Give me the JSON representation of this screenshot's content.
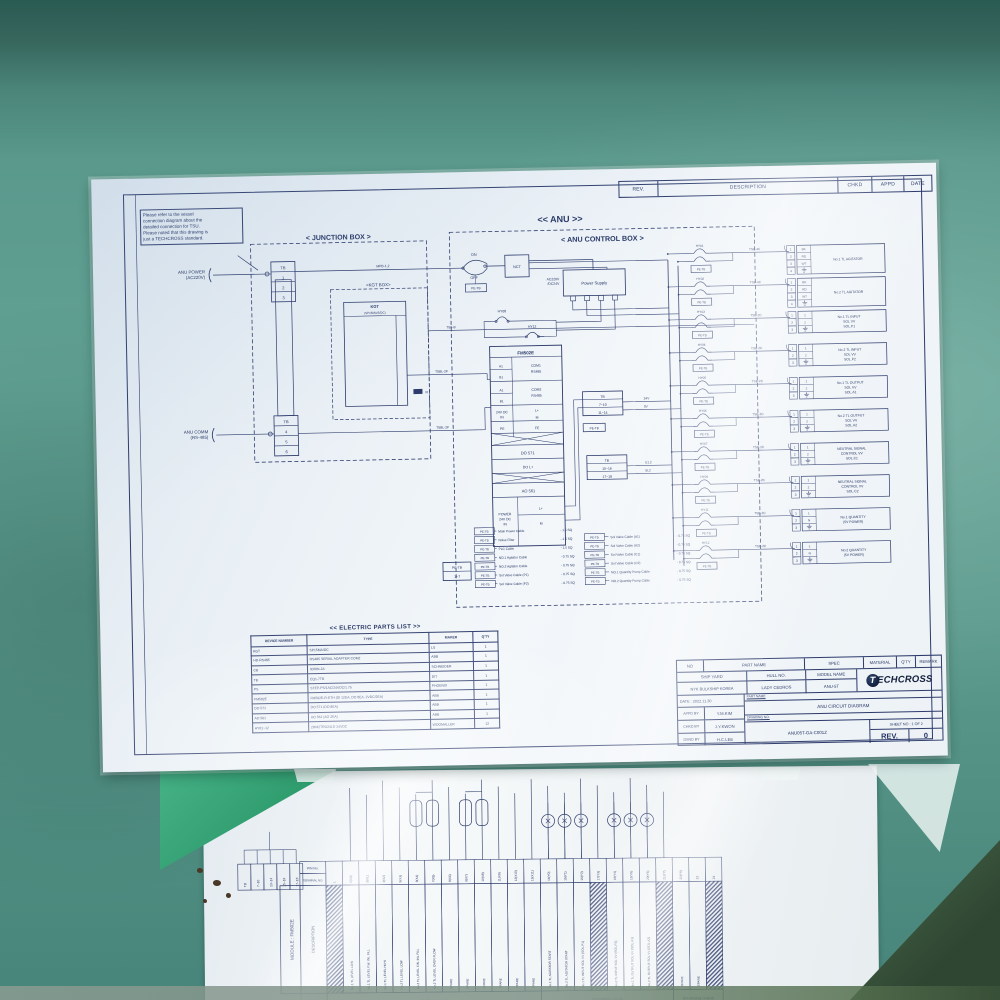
{
  "colors": {
    "surface_teal": "#5a998c",
    "mat_green": "#2f9c6e",
    "paper": "#f3f7fa",
    "ink": "#2c3a6b",
    "logo_navy": "#131f3d"
  },
  "sheet1": {
    "rev_headers": [
      "REV.",
      "DESCRIPTION",
      "CHKD",
      "APPD",
      "DATE"
    ],
    "note_lines": [
      "Please refer to the vessel",
      "connection diagram about the",
      "detailed connection for TSU.",
      "Please noted that this drawing is",
      "just a TECHCROSS standard."
    ],
    "anu": "<< ANU >>",
    "jb": "< JUNCTION BOX >",
    "cb": "< ANU CONTROL BOX >",
    "kgt_box": "<KGT BOX>",
    "anu_power": [
      "ANU POWER",
      "(AC220V)"
    ],
    "anu_comm": [
      "ANU COMM",
      "(RS-485)"
    ],
    "tb": "TB",
    "tb_top": [
      "1",
      "2",
      "3"
    ],
    "tb_bot": [
      "4",
      "5",
      "6"
    ],
    "mpb": "MPB-1,2",
    "kgt": {
      "name": "KGT",
      "type": "(SP15MA/5/DC)",
      "rows": [
        [
          "LEFT TL",
          "ALRM",
          "LAMP"
        ],
        [
          "RIGHT TL",
          "ALRM",
          "LAMP"
        ],
        [
          "POWER",
          ""
        ]
      ],
      "pin_labels": [
        "RTB-P",
        "RTB-N",
        "RT15-P",
        "RT15-N",
        "VTB",
        "GND"
      ],
      "com": [
        "COM",
        "(RS485)"
      ],
      "com_pins": [
        "485(A)",
        "485(B)",
        "485(A)",
        "485(B)"
      ],
      "com_wires": [
        "485(+)",
        "485(-)"
      ],
      "r": "R"
    },
    "long_wires": [
      "TSB-B",
      "TSBL-2P",
      "TSBL-2P"
    ],
    "on": "ON",
    "off": "OFF",
    "nct": "NCT",
    "petb": "PE-TB",
    "ps": [
      "Power Supply",
      "AC220V",
      "/DC24V"
    ],
    "hy_top": [
      "HY08",
      "HY12"
    ],
    "module": {
      "name": "FM502E",
      "com1": [
        "COM1",
        "RS485"
      ],
      "com2": [
        "COM2",
        "RS485"
      ],
      "a1": "A1",
      "b1": "B1",
      "dc": [
        "24V DC",
        "IN"
      ],
      "lp": "L+",
      "m": "M",
      "pe": "PE",
      "fe": "FE",
      "do571": "DO 571",
      "dol": "DO L+",
      "ao561": "AO 561",
      "power": [
        "POWER",
        "24V DC",
        "IN"
      ]
    },
    "tb1": [
      "TB",
      "7~10",
      "11~14"
    ],
    "tb2": [
      "TB",
      "15~16",
      "17~18"
    ],
    "wire_24": [
      "24V",
      "0V"
    ],
    "wire_u": [
      "U1.2",
      "SL2"
    ]
  },
  "outputs": [
    {
      "relay": "HY01",
      "cable": "TSB-4C",
      "pins": [
        "1",
        "2",
        "3",
        "4"
      ],
      "names": [
        "BK",
        "RD",
        "WT",
        "G"
      ],
      "label": [
        "No.1 TL AGITATOR"
      ]
    },
    {
      "relay": "HY02",
      "cable": "TSB-4C",
      "pins": [
        "1",
        "2",
        "3",
        "4"
      ],
      "names": [
        "BK",
        "RD",
        "WT",
        "G"
      ],
      "label": [
        "No.2 TL AGITATOR"
      ]
    },
    {
      "relay": "HY03",
      "cable": "TSB-2C",
      "pins": [
        "1",
        "2",
        "3"
      ],
      "names": [
        "1",
        "2",
        "G"
      ],
      "label": [
        "No.1 TL INPUT",
        "SOL VV",
        "SOL.P1"
      ]
    },
    {
      "relay": "HY04",
      "cable": "TSB-2C",
      "pins": [
        "1",
        "2",
        "3"
      ],
      "names": [
        "1",
        "2",
        "G"
      ],
      "label": [
        "No.2 TL INPUT",
        "SOL VV",
        "SOL.P2"
      ]
    },
    {
      "relay": "HY05",
      "cable": "TSB-2C",
      "pins": [
        "1",
        "2",
        "3"
      ],
      "names": [
        "1",
        "2",
        "G"
      ],
      "label": [
        "No.1 TL OUTPUT",
        "SOL VV",
        "SOL.A1"
      ]
    },
    {
      "relay": "HY06",
      "cable": "TSB-2C",
      "pins": [
        "1",
        "2",
        "3"
      ],
      "names": [
        "1",
        "2",
        "G"
      ],
      "label": [
        "No.2 TL OUTPUT",
        "SOL VV",
        "SOL.A2"
      ]
    },
    {
      "relay": "HY07",
      "cable": "TSB-2C",
      "pins": [
        "1",
        "2",
        "3"
      ],
      "names": [
        "1",
        "2",
        "G"
      ],
      "label": [
        "NEUTRAL SIGNAL",
        "CONTROL VV",
        "SOL.C1"
      ]
    },
    {
      "relay": "HY09",
      "cable": "TSB-2C",
      "pins": [
        "1",
        "2",
        "3"
      ],
      "names": [
        "1",
        "2",
        "G"
      ],
      "label": [
        "NEUTRAL SIGNAL",
        "CONTROL VV",
        "SOL.C2"
      ]
    },
    {
      "relay": "HY11",
      "cable": "TSB-2C",
      "pins": [
        "1",
        "2",
        "3"
      ],
      "names": [
        "L",
        "N",
        "G"
      ],
      "label": [
        "No.1 QUANTITY",
        "(5V POWER)"
      ]
    },
    {
      "relay": "HY12",
      "cable": "TSB-2C",
      "pins": [
        "1",
        "2",
        "3"
      ],
      "names": [
        "L",
        "N",
        "G"
      ],
      "label": [
        "No.2 QUANTITY",
        "(5V POWER)"
      ]
    }
  ],
  "pe_legend": {
    "box": [
      "PE-TB",
      "1~7"
    ],
    "tag": "PE-TB",
    "left": [
      [
        "Main Power Cable",
        "- 1.5 SQ"
      ],
      [
        "Noise Filter",
        "- 1.5 SQ"
      ],
      [
        "PLC Cable",
        "- 1.5 SQ"
      ],
      [
        "NO.1 Agitator Cable",
        "- 0.75 SQ"
      ],
      [
        "NO.2 Agitator Cable",
        "- 0.75 SQ"
      ],
      [
        "Sol Valve Cable (P1)",
        "- 0.75 SQ"
      ],
      [
        "Sol Valve Cable (P2)",
        "- 0.75 SQ"
      ]
    ],
    "right": [
      [
        "Sol Valve Cable (A1)",
        "- 0.75 SQ"
      ],
      [
        "Sol Valve Cable (A2)",
        "- 0.75 SQ"
      ],
      [
        "Sol Valve Cable (C1)",
        "- 0.75 SQ"
      ],
      [
        "Sol Valve Cable (C2)",
        "- 0.75 SQ"
      ],
      [
        "NO.1 Quantity Pump Cable",
        "- 0.75 SQ"
      ],
      [
        "NO.2 Quantity Pump Cable",
        "- 0.75 SQ"
      ]
    ]
  },
  "parts": {
    "title": "<< ELECTRIC PARTS LIST >>",
    "headers": [
      "DEVICE NUMBER",
      "TYPE",
      "MAKER",
      "Q'TY"
    ],
    "rows": [
      [
        "KGT",
        "SP15MA/DC",
        "LS",
        "1"
      ],
      [
        "HD-RS485",
        "RS485 SERIAL ADAPTER COM2",
        "ABB",
        "1"
      ],
      [
        "CB",
        "IC60N-2A",
        "SCHNEIDER",
        "1"
      ],
      [
        "TB",
        "EQ1-7TB",
        "DIT",
        "1"
      ],
      [
        "PS",
        "STEP-PS/1AC/24VDC/1.75",
        "PHOENIX",
        "1"
      ],
      [
        "FM502E",
        "FM502E-R-ETH (DI 12EA, DO 8EA, 2VDC/2EA)",
        "ABB",
        "1"
      ],
      [
        "DO 571",
        "DO 571 (DO 8EA)",
        "ABB",
        "1"
      ],
      [
        "AO 561",
        "AO 561 (AO 2EA)",
        "ABB",
        "1"
      ],
      [
        "HY01~12",
        "2RM2TRO24LD  24VDC",
        "WOOMALLER",
        "12"
      ]
    ]
  },
  "tblock": {
    "row1": [
      "NO",
      "PART NAME",
      "SPEC",
      "MATERIAL",
      "Q'TY",
      "REMARK"
    ],
    "ship_yard_h": "SHIP YARD",
    "hull_h": "HULL NO.",
    "model_h": "MODEL NAME",
    "ship_yard": "NYK BULKSHIP KOREA",
    "hull": "LADY CEDROS",
    "model": "ANU-5T",
    "date": "DATE : 2022.11.30",
    "appd_h": "APPD BY",
    "appd": "Y.M.KIM",
    "chkd_h": "CHKD BY",
    "chkd": "J.Y.KWON",
    "dsnd_h": "DSND BY",
    "dsnd": "H.C.LEE",
    "part_h": "PART NAME",
    "part": "ANU CIRCUIT DIAGRAM",
    "dwg_h": "DRAWING NO.",
    "dwg": "ANU05T-GA-C001Z",
    "sheet_no": "SHEET NO : 1 OF 2",
    "rev_h": "REV.",
    "rev": "0",
    "logo_t": "T",
    "logo_word": "ECHCROSS"
  },
  "sheet2": {
    "module": "MODULE : FM502E",
    "pin_h": "PIN No.",
    "term_h": "TERMINAL NO.",
    "desc_h": "DESCRIPTION",
    "sig_h": "SIGNAL",
    "tb_cells": [
      "TB",
      "7~10",
      "13~14",
      "15~16",
      "17~18"
    ],
    "pins": [
      "1",
      "2(X0)",
      "3(X1)",
      "4(X2)",
      "5(X3)",
      "6(X4)",
      "7(X5)",
      "8(X6)",
      "9(X7)",
      "10(X8)",
      "11(X9)",
      "12(X10)",
      "13(X11)",
      "14(Y0)",
      "15(Y1)",
      "16(Y2)",
      "17(Y3)",
      "18(Y4)",
      "19(Y5)",
      "20(Y6)",
      "21(Y7)",
      "22(Y8)",
      "23",
      "24"
    ],
    "descriptions": [
      "",
      "No.1 TL LEVEL LOW",
      "No.1 TL LEVEL F.W. INL FILL",
      "No.1 TL LEVEL HI-HI",
      "No.2 TL LEVEL LOW",
      "No.2 TL LEVEL F.W. INL FILL",
      "No.2 TL LEVEL OVER FLOW",
      "SPARE",
      "SPARE",
      "SPARE",
      "SPARE",
      "SPARE",
      "SPARE",
      "No.1 TL AGITATOR START",
      "No.2 TL AGITATOR START",
      "No.1 TL INPUT SOL VV (SOL.P1)",
      "",
      "No.2 TL INPUT SOL VV (SOL.P2)",
      "No.1 TL OUTPUT SOL VV (SOL.A1)",
      "No.2 TL OUTPUT SOL VV (SOL.A2)",
      "",
      "SPARE",
      "SPARE",
      ""
    ],
    "hatched": [
      0,
      16,
      20,
      23
    ],
    "signals": [
      {
        "label": "DI (Digital Input)",
        "from": 0,
        "to": 12
      },
      {
        "label": "DO (Digital Output)",
        "from": 13,
        "to": 20
      },
      {
        "label": "AO (Analog Output)",
        "from": 21,
        "to": 23
      }
    ]
  }
}
